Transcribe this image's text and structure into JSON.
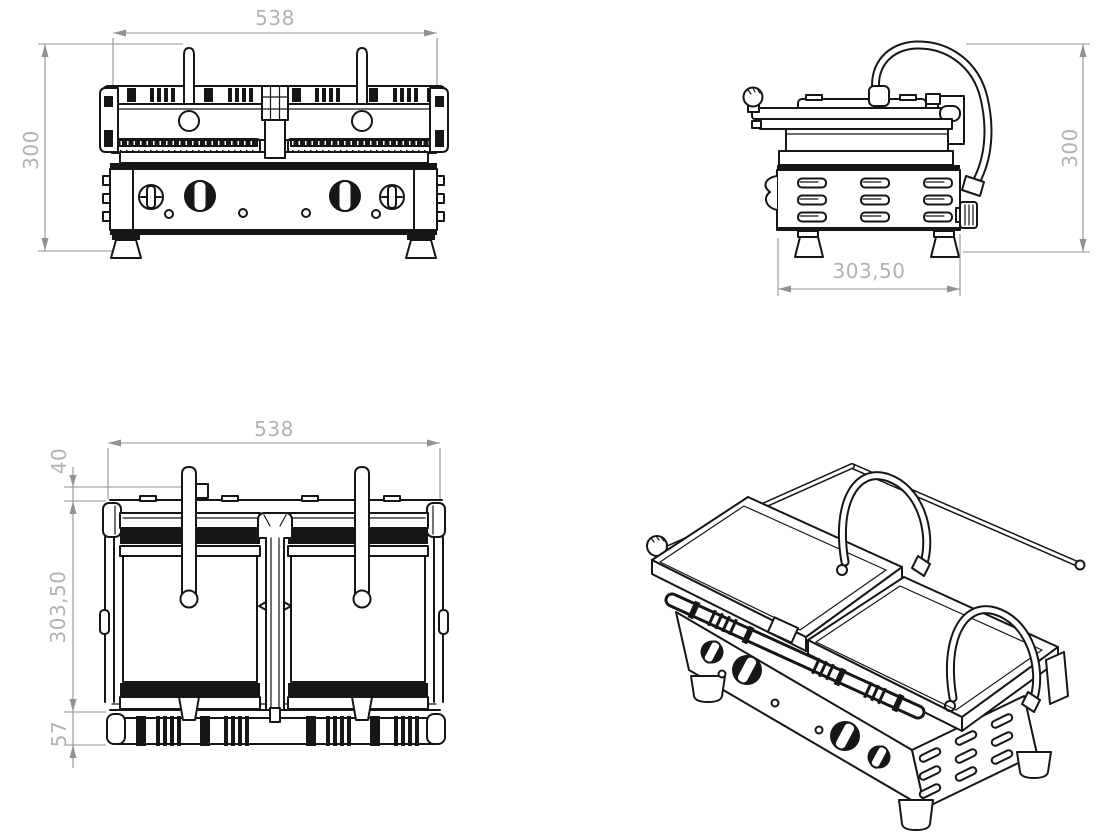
{
  "drawing": {
    "subject": "double-contact-grill",
    "units": "mm",
    "colors": {
      "background": "#ffffff",
      "line": "#161616",
      "dimension_line": "#929292",
      "dimension_text": "#b2b2b2"
    },
    "views": {
      "front": {
        "name": "front-view",
        "dim_width": "538",
        "dim_height": "300"
      },
      "side": {
        "name": "side-view",
        "dim_height": "300",
        "dim_depth": "303,50"
      },
      "top": {
        "name": "top-view",
        "dim_width": "538",
        "dim_handle": "40",
        "dim_depth": "303,50",
        "dim_hinge": "57"
      },
      "iso": {
        "name": "isometric-view"
      }
    }
  }
}
